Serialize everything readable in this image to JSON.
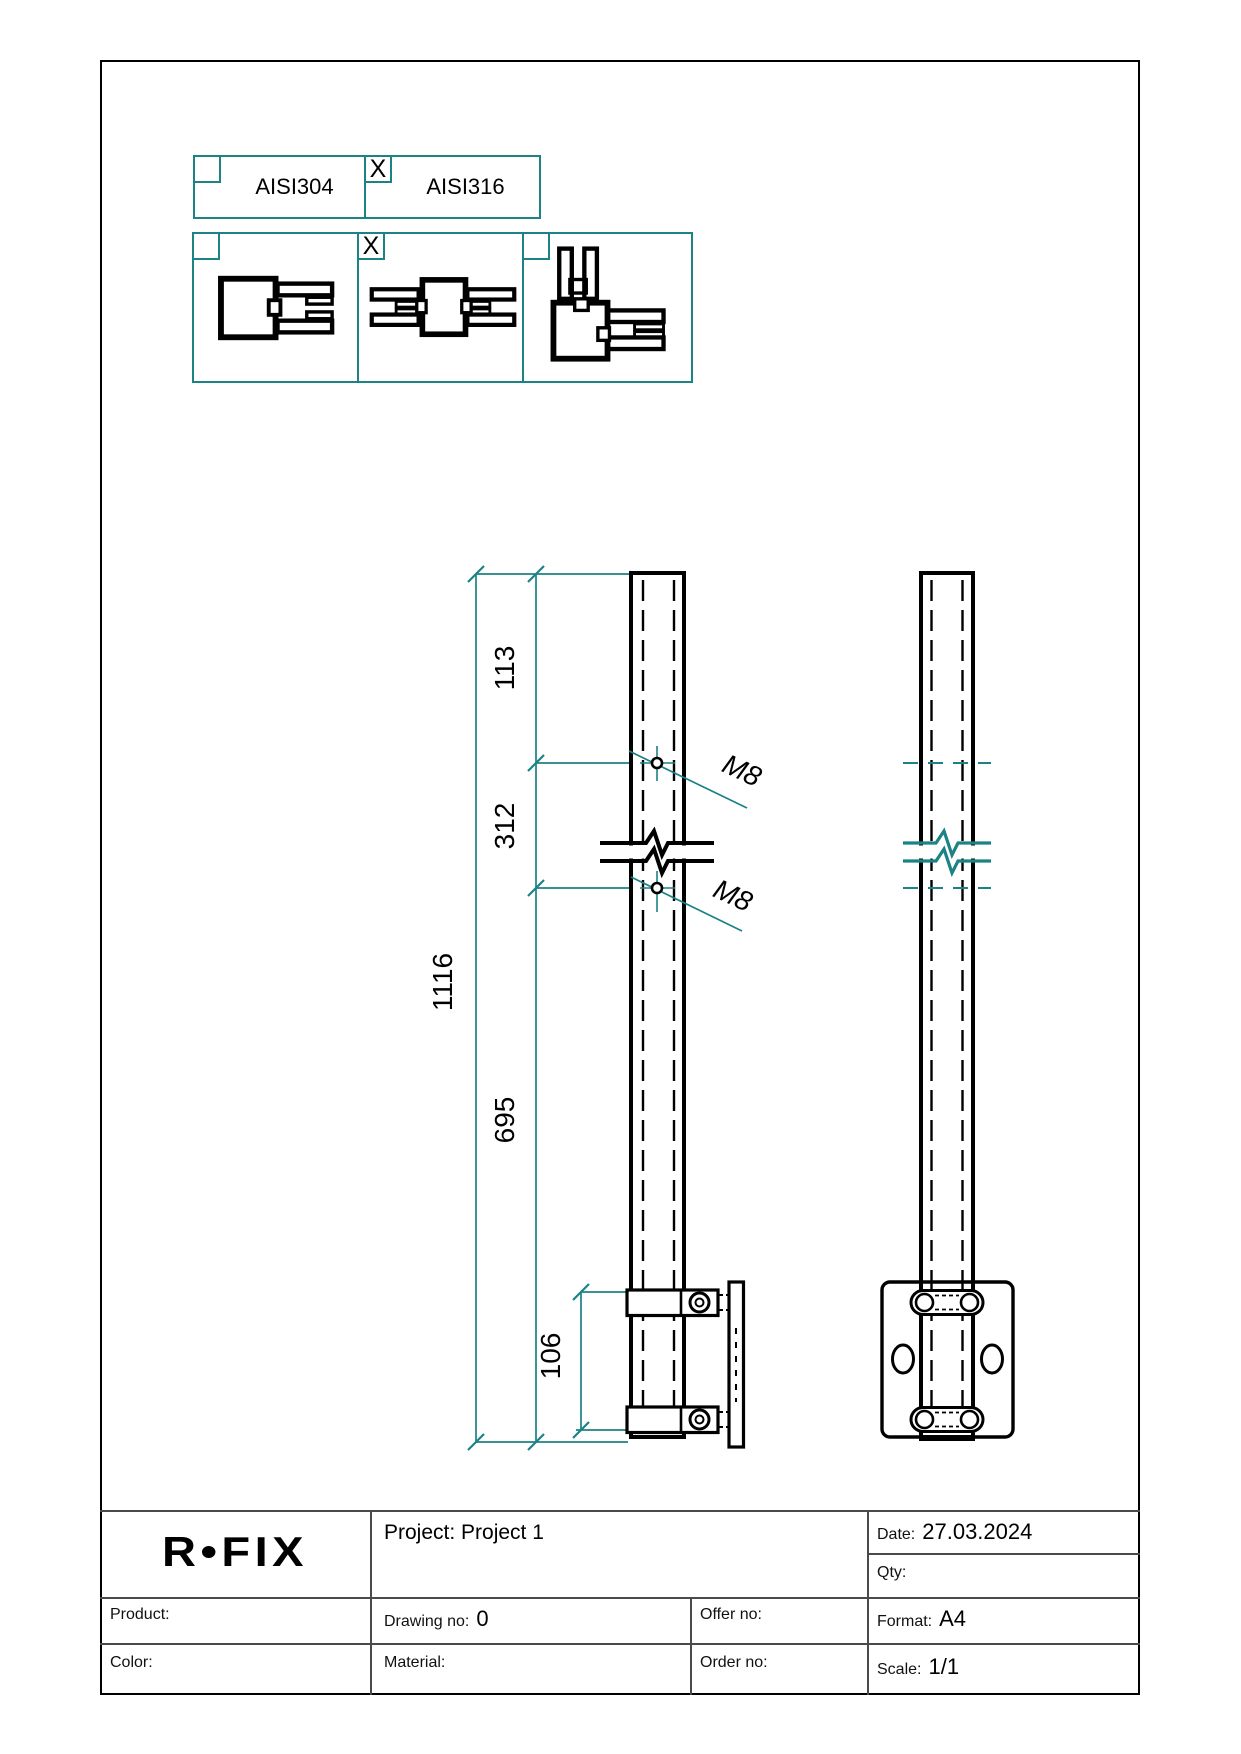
{
  "material_selector": {
    "checked_mark": "X",
    "options": [
      {
        "label": "AISI304",
        "checked": false,
        "mark": ""
      },
      {
        "label": "AISI316",
        "checked": true,
        "mark": "X"
      }
    ]
  },
  "mount_selector": {
    "checked_mark": "X",
    "options": [
      {
        "icon": "post-end-mount-icon",
        "checked": false,
        "mark": ""
      },
      {
        "icon": "post-mid-mount-icon",
        "checked": true,
        "mark": "X"
      },
      {
        "icon": "post-corner-mount-icon",
        "checked": false,
        "mark": ""
      }
    ]
  },
  "drawing": {
    "dimensions": {
      "overall": "1116",
      "segment_top": "113",
      "segment_mid": "312",
      "segment_bottom": "695",
      "bracket_spacing": "106"
    },
    "thread_label_1": "M8",
    "thread_label_2": "M8"
  },
  "title_block": {
    "logo": "R•FIX",
    "project_label": "Project: Project 1",
    "date_label": "Date:",
    "date_value": "27.03.2024",
    "qty_label": "Qty:",
    "product_label": "Product:",
    "drawing_no_label": "Drawing no:",
    "drawing_no_value": "0",
    "offer_no_label": "Offer no:",
    "format_label": "Format:",
    "format_value": "A4",
    "color_label": "Color:",
    "material_label": "Material:",
    "order_no_label": "Order no:",
    "scale_label": "Scale:",
    "scale_value": "1/1"
  },
  "colors": {
    "accent_teal": "#1b8285",
    "line_black": "#000000"
  }
}
